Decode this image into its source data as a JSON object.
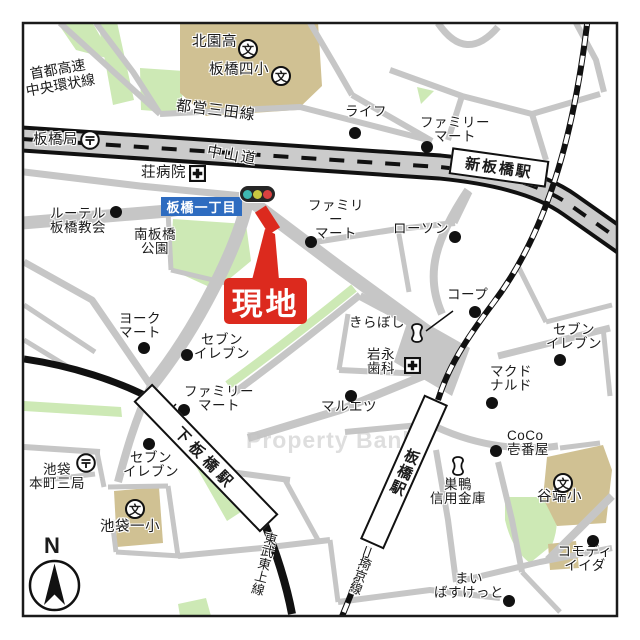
{
  "watermark": "Property Bank",
  "site": {
    "label": "現地"
  },
  "compass": {
    "north": "N"
  },
  "intersection": {
    "label": "板橋一丁目"
  },
  "traffic_light": {
    "colors": [
      "#3eb8b2",
      "#c8c840",
      "#d94040"
    ]
  },
  "stations": {
    "shin_itabashi": "新板橋駅",
    "itabashi": "板橋駅",
    "shimo_itabashi": "下板橋駅"
  },
  "lines": {
    "toei_mita": "都営三田線",
    "shuto_expressway": "首都高速\n中央環状線",
    "nakasendo": "中山道",
    "saikyo": "埼京線",
    "tobu_tojo": "東武東上線"
  },
  "icons": {
    "school_char": "文"
  },
  "palette": {
    "site_red": "#dc2a1e",
    "intersection_blue": "#2e6cc0",
    "park_green": "#cde9b5",
    "school_tan": "#d0c193",
    "road_gray": "#c6c6c6"
  },
  "places": {
    "kitazono_high": "北園高",
    "itabashi_4sho": "板橋四小",
    "life": "ライフ",
    "familymart_ne": "ファミリー\nマート",
    "itabashi_post": "板橋局",
    "sho_hospital": "荘病院",
    "familymart_c": "ファミリー\nマート",
    "lawson": "ローソン",
    "lutheran_church": "ルーテル\n板橋教会",
    "minami_park": "南板橋\n公園",
    "coop": "コープ",
    "york_mart": "ヨーク\nマート",
    "seven_center": "セブン\nイレブン",
    "kiraboshi": "きらぼし",
    "seven_east": "セブン\nイレブン",
    "iwanaga_dental": "岩永\n歯科",
    "mcdonalds": "マクド\nナルド",
    "familymart_s": "ファミリー\nマート",
    "maruetsu": "マルエツ",
    "coco_ichibanya": "CoCo\n壱番屋",
    "seven_sw": "セブン\nイレブン",
    "ikebukuro_post": "池袋\n本町三局",
    "ikebukuro_1sho": "池袋一小",
    "sugamo_shinkin": "巣鴨\n信用金庫",
    "yabata_sho": "谷端小",
    "commodi_iida": "コモディ\nイイダ",
    "my_basket": "まい\nばすけっと"
  }
}
